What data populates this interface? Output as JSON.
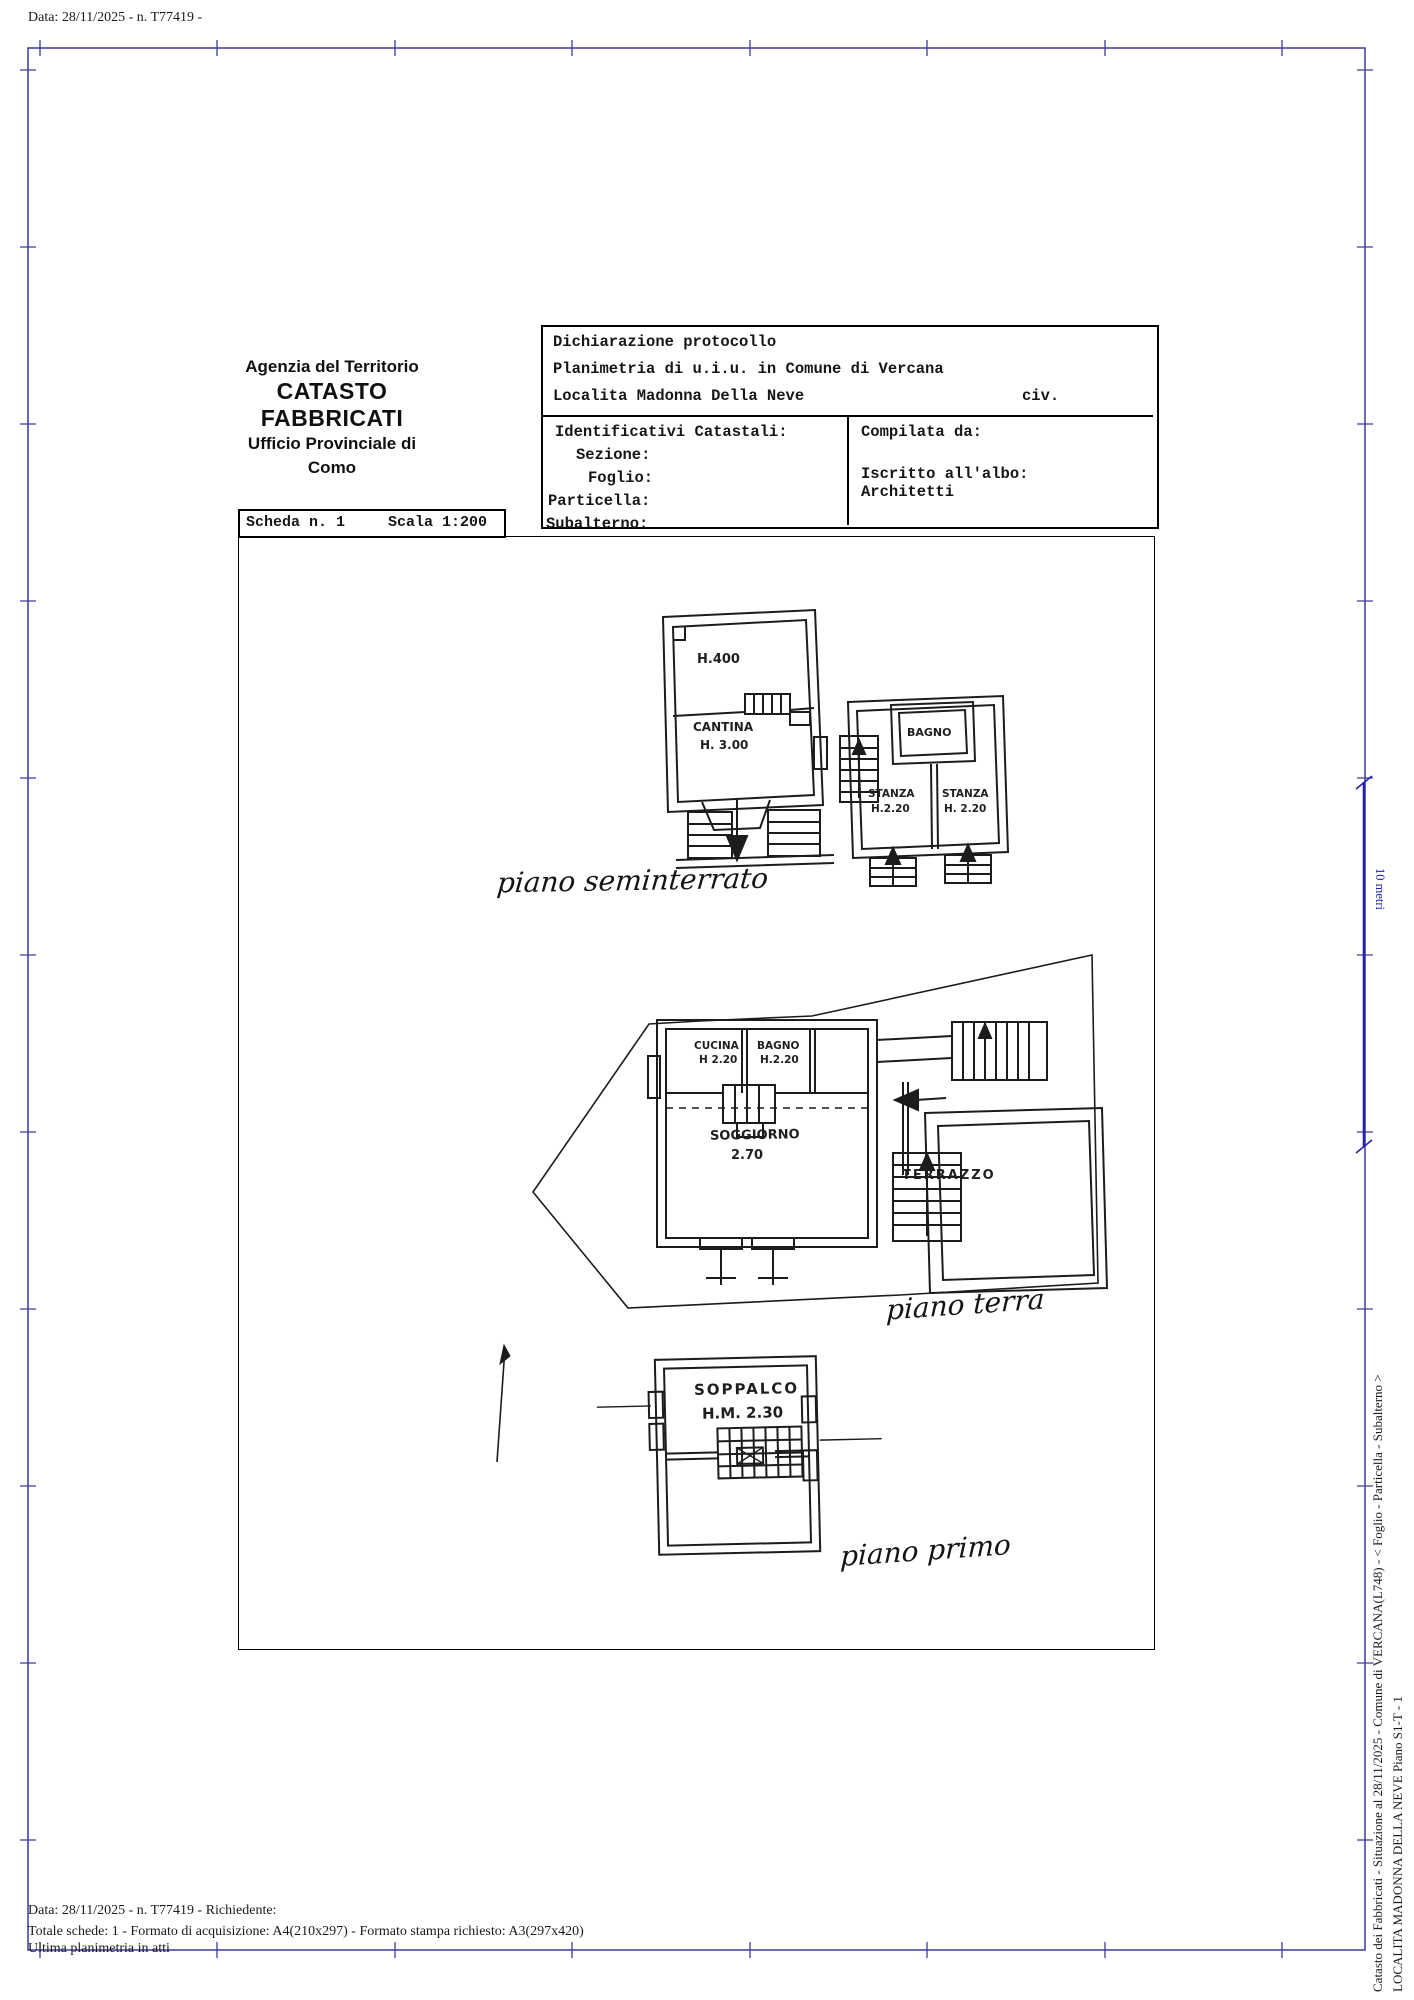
{
  "colors": {
    "frame_blue": "#3c3c9c",
    "scale_bar_blue": "#2323aa",
    "ink": "#1c1c1c"
  },
  "top_note": "Data: 28/11/2025 - n. T77419 -",
  "header": {
    "agency": "Agenzia del Territorio",
    "registry": "CATASTO FABBRICATI",
    "office": "Ufficio Provinciale di",
    "city": "Como"
  },
  "protocol": {
    "line1": "Dichiarazione protocollo",
    "line2": "Planimetria di u.i.u. in Comune di Vercana",
    "line3": "Localita Madonna Della Neve",
    "civ": "civ.",
    "identificativi_title": "Identificativi Catastali:",
    "sezione": "Sezione:",
    "foglio": "Foglio:",
    "particella": "Particella:",
    "subalterno": "Subalterno:",
    "compilata": "Compilata da:",
    "iscritto": "Iscritto all'albo:",
    "albo": "Architetti"
  },
  "scheda": {
    "number": "Scheda n. 1",
    "scala": "Scala 1:200"
  },
  "plans": {
    "seminterrato": {
      "caption": "piano seminterrato",
      "h400": "H.400",
      "cantina": "CANTINA",
      "cantina_h": "H. 3.00",
      "bagno": "BAGNO",
      "stanza1": "STANZA",
      "stanza1_h": "H.2.20",
      "stanza2": "STANZA",
      "stanza2_h": "H. 2.20"
    },
    "terra": {
      "caption": "piano terra",
      "cucina": "CUCINA",
      "cucina_h": "H 2.20",
      "bagno": "BAGNO",
      "bagno_h": "H.2.20",
      "soggiorno": "SOGGIORNO",
      "soggiorno_h": "2.70",
      "terrazzo": "TERRAZZO"
    },
    "primo": {
      "caption": "piano primo",
      "soppalco": "SOPPALCO",
      "soppalco_h": "H.M. 2.30"
    }
  },
  "scale_bar": {
    "label": "10 metri"
  },
  "sidebar": {
    "line1": "Catasto dei Fabbricati - Situazione al 28/11/2025 - Comune di VERCANA(L748) - < Foglio  - Particella    - Subalterno    >",
    "line2": "LOCALITA MADONNA DELLA NEVE Piano S1-T - 1"
  },
  "footer": {
    "line1": "Data: 28/11/2025 - n. T77419 - Richiedente:",
    "line2": "Totale schede: 1 - Formato di acquisizione: A4(210x297)  - Formato stampa richiesto: A3(297x420)",
    "line3": "Ultima planimetria in atti"
  }
}
